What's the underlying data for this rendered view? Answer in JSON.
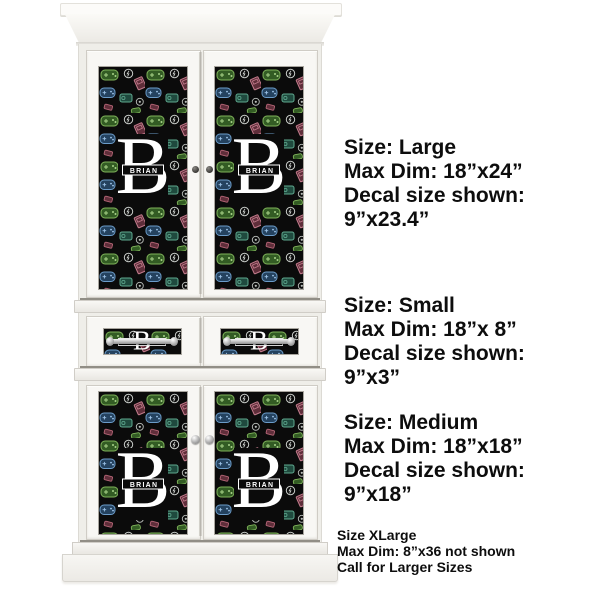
{
  "product": {
    "type": "armoire-cabinet-with-custom-decals",
    "monogram_initial": "B",
    "monogram_name": "BRIAN",
    "decal_theme": "video-game-icons-on-black"
  },
  "size_blocks": [
    {
      "size_label": "Size: Large",
      "max_dim": "Max Dim: 18”x24”",
      "shown_label": "Decal size shown:",
      "shown_value": "9”x23.4”"
    },
    {
      "size_label": "Size: Small",
      "max_dim": "Max Dim: 18”x 8”",
      "shown_label": "Decal size shown:",
      "shown_value": "9”x3”"
    },
    {
      "size_label": "Size: Medium",
      "max_dim": "Max Dim: 18”x18”",
      "shown_label": "Decal size shown:",
      "shown_value": "9”x18”"
    }
  ],
  "footnote": {
    "line1": "Size XLarge",
    "line2": "Max Dim: 8”x36 not shown",
    "line3": "Call for Larger Sizes"
  },
  "colors": {
    "cabinet_white": "#f8f7f4",
    "decal_background": "#0b0b0b",
    "icon_green": "#7fb35a",
    "icon_blue": "#6b9cc9",
    "icon_pink": "#c37b8c",
    "icon_teal": "#5fa98f",
    "icon_white": "#c9cdc9",
    "text_black": "#0d0d0d"
  }
}
